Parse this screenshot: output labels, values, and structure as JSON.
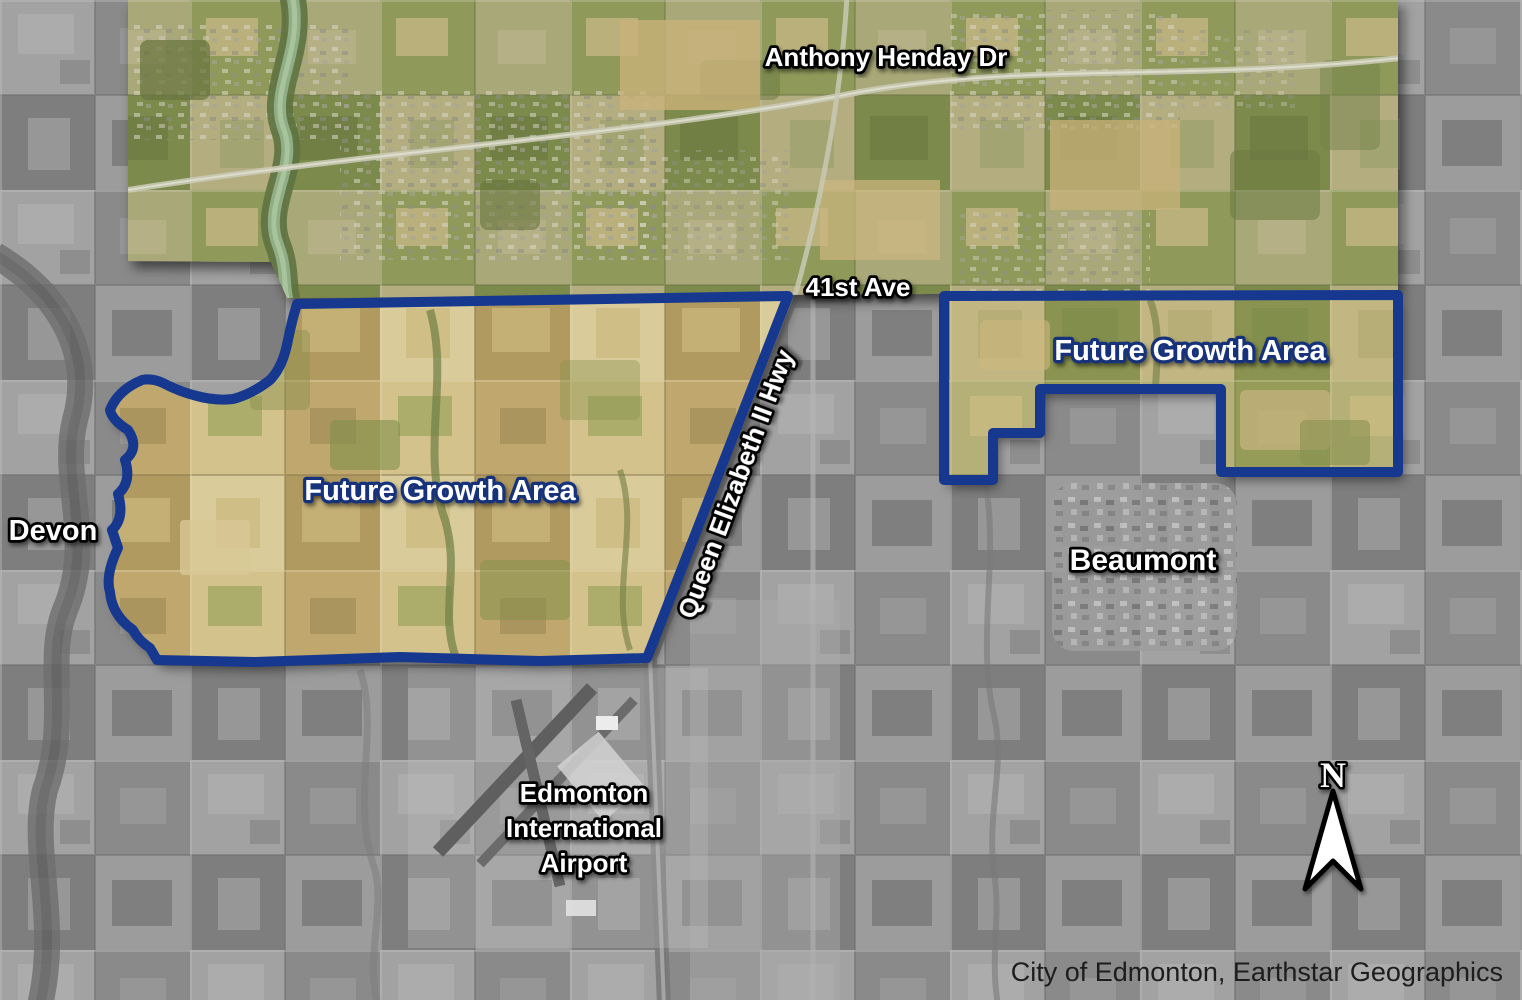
{
  "map": {
    "title": "Edmonton Future Growth Areas satellite map",
    "labels": {
      "anthony_henday": "Anthony Henday Dr",
      "forty_first_ave": "41st Ave",
      "queen_elizabeth_hwy": "Queen Elizabeth II Hwy",
      "future_growth_west": "Future Growth Area",
      "future_growth_east": "Future Growth Area",
      "devon": "Devon",
      "beaumont": "Beaumont",
      "airport_line1": "Edmonton",
      "airport_line2": "International",
      "airport_line3": "Airport",
      "north_indicator": "N",
      "attribution": "City of Edmonton, Earthstar Geographics"
    },
    "colors": {
      "growth_boundary_blue": "#16388f",
      "growth_label_outline_navy": "#16337a",
      "label_fill_white": "#ffffff",
      "label_outline_black": "#000000",
      "attribution_text": "#1d1d1d",
      "farmland_tan": "#c9b47e",
      "city_band_olive": "#9aa065",
      "grayscale_base": "#949494"
    }
  }
}
